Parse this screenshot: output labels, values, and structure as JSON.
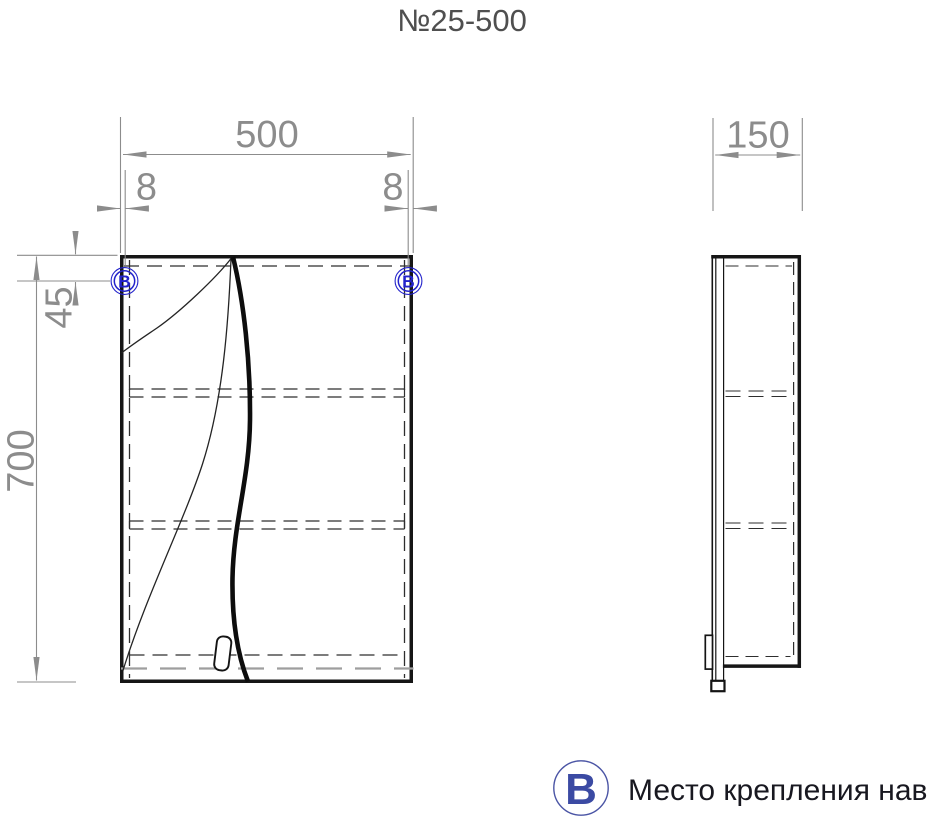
{
  "title": "№25-500",
  "dims": {
    "width": "500",
    "offset_left": "8",
    "offset_right": "8",
    "hanger_top": "45",
    "height": "700",
    "depth": "150"
  },
  "markers": {
    "left": "В",
    "right": "В"
  },
  "legend": {
    "symbol": "В",
    "label": "Место крепления навесов"
  },
  "drawing": {
    "views": [
      {
        "name": "front",
        "width_mm": 500,
        "height_mm": 700,
        "hanger_offset_top_mm": 45,
        "hanger_offset_side_mm": 8
      },
      {
        "name": "side",
        "depth_mm": 150
      }
    ],
    "colors": {
      "line": "#161616",
      "hidden_line": "#2e2e2e",
      "dim": "#8c8c8c",
      "marker_blue": "#2323cb",
      "legend_blue": "#3b4aa3"
    }
  }
}
